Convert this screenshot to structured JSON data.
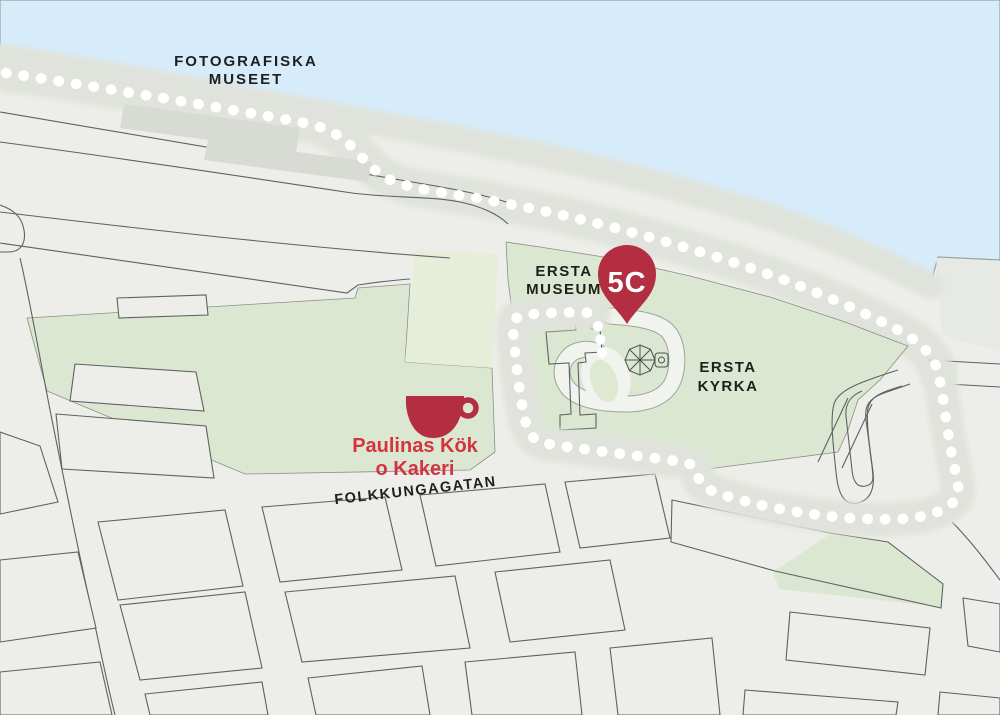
{
  "map": {
    "title": "Ersta area map with walking path",
    "labels": {
      "fotografiska": {
        "line1": "FOTOGRAFISKA",
        "line2": "MUSEET"
      },
      "ersta_museum": {
        "line1": "ERSTA",
        "line2": "MUSEUM"
      },
      "ersta_kyrka": {
        "line1": "ERSTA",
        "line2": "KYRKA"
      },
      "street": {
        "name": "FOLKKUNGAGATAN"
      },
      "poi": {
        "line1": "Paulinas Kök",
        "line2": "o Kakeri"
      },
      "pin": {
        "text": "5C"
      }
    },
    "icons": {
      "pin": "map-pin-icon",
      "cup": "coffee-cup-icon",
      "dome": "chapel-dome-icon",
      "path": "dotted-walking-path"
    },
    "colors": {
      "water": "#d6ecfa",
      "land": "#edeee9",
      "park_green": "#dce7d1",
      "park_light_green": "#e6eeda",
      "building_gray": "#d8dad4",
      "road_line": "#5e6164",
      "promenade": "#e0e3dc",
      "path_dot": "#ffffff",
      "pin_red": "#b22e40",
      "poi_text_red": "#d23540",
      "label_dark": "#1f1f1d"
    }
  }
}
